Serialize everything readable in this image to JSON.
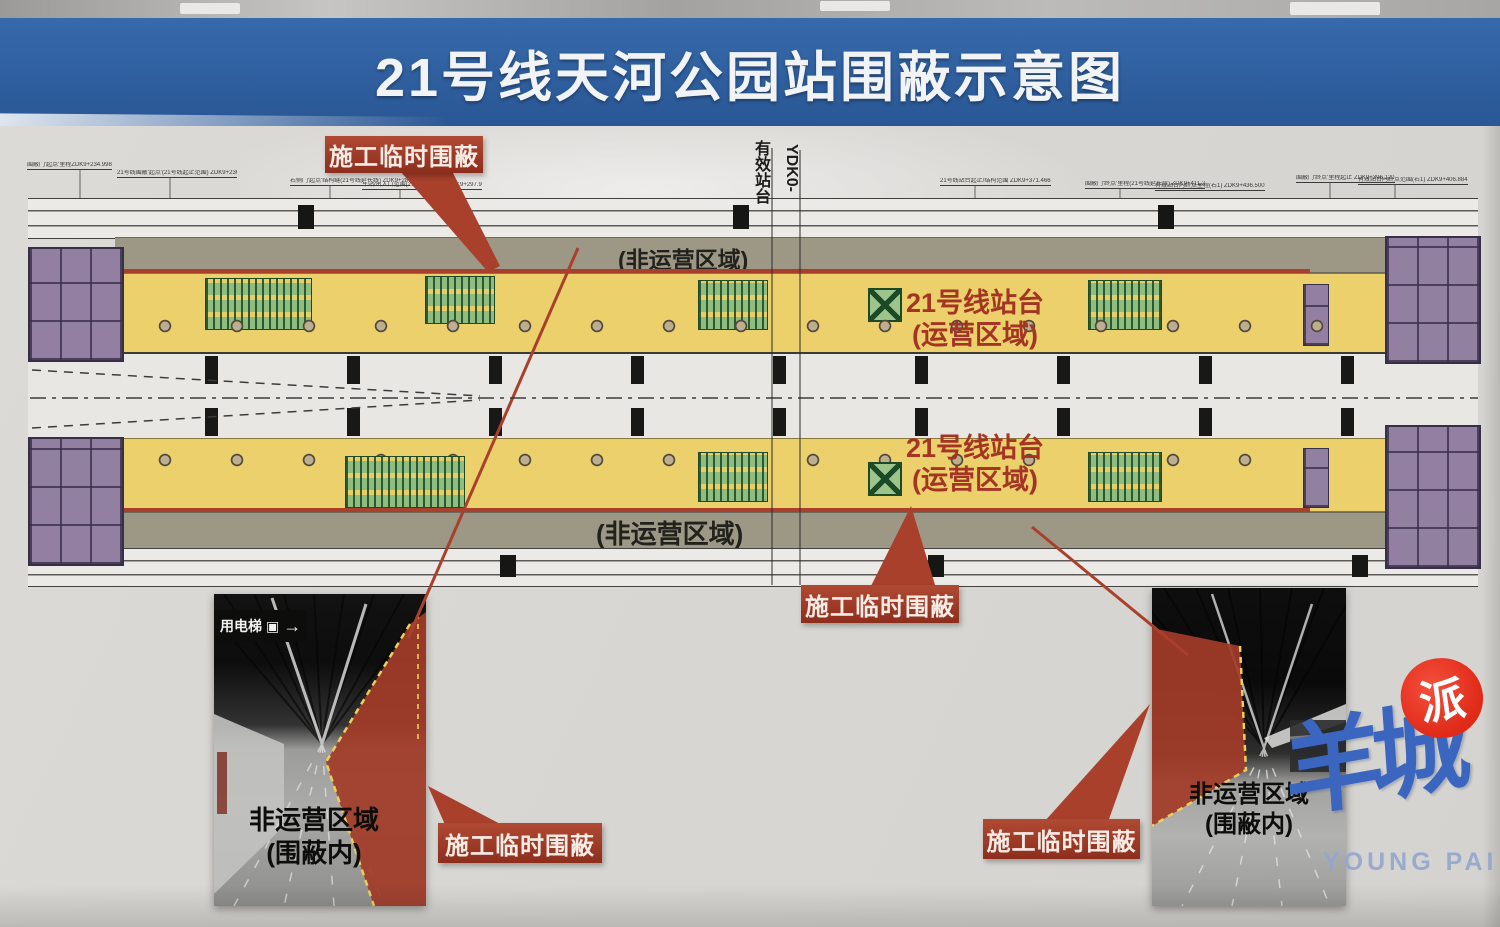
{
  "title": "21号线天河公园站围蔽示意图",
  "diagram": {
    "marker_effective_platform": "有效站台",
    "marker_chainage": "YDK0-",
    "non_operating_top": "(非运营区域)",
    "non_operating_bottom": "(非运营区域)",
    "platform_upper": {
      "line1": "21号线站台",
      "line2": "(运营区域)"
    },
    "platform_lower": {
      "line1": "21号线站台",
      "line2": "(运营区域)"
    },
    "callout_enclosure_top": "施工临时围蔽",
    "callout_enclosure_bottom": "施工临时围蔽",
    "annotations": [
      "围蔽门'起点'里程ZDK9+234.998",
      "21号线围蔽'起点'(21号线起止范围) ZDK9+236.500",
      "右侧门'起点'结构缝(21号线延长线) ZDK9+287.000",
      "车站/出入口范围(21号线延长线) ZDK9+297.900",
      "21号线站台起止/结构范围 ZDK9+371.466",
      "围蔽门'终点'里程(21号线延长段) ZDK9+411.200",
      "有效站台内终点里程(右1) ZDK9+436.500",
      "围蔽门'终点'里程起止 ZDK9+396.120",
      "有效站台内终点范围(右1) ZDK9+406.884"
    ]
  },
  "photos": {
    "left": {
      "sign": "用电梯",
      "sign_icon": "▣",
      "sign_arrow": "→",
      "caption1": "非运营区域",
      "caption2": "(围蔽内)",
      "callout": "施工临时围蔽"
    },
    "right": {
      "caption1": "非运营区域",
      "caption2": "(围蔽内)",
      "callout": "施工临时围蔽"
    }
  },
  "watermark": {
    "cn": "羊城",
    "seal": "派",
    "en": "YOUNG PAI"
  },
  "colors": {
    "header_blue": "#2f5f9f",
    "enclosure_red": "#a9402c",
    "platform_yellow": "#ebd06b",
    "non_op_gray": "#9d9886",
    "callout_red": "#9e3526"
  }
}
